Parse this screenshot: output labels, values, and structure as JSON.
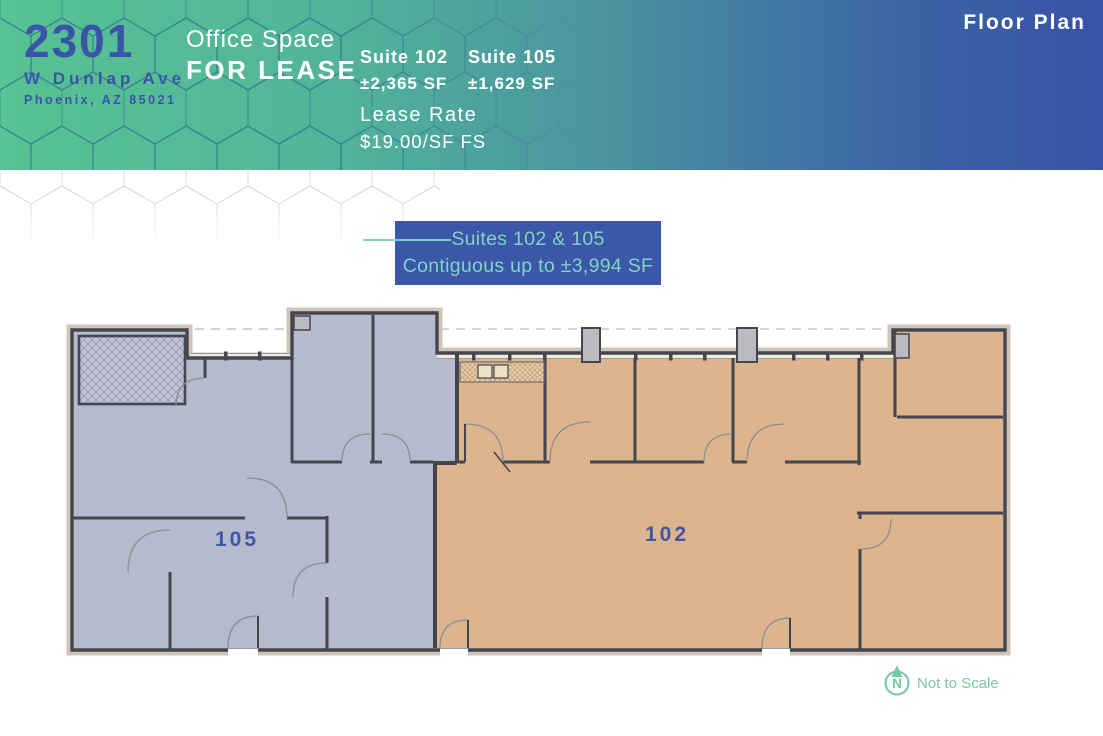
{
  "header": {
    "address_number": "2301",
    "address_street": "W Dunlap Ave",
    "address_city": "Phoenix, AZ 85021",
    "offer_line1": "Office Space",
    "offer_line2": "FOR LEASE",
    "page_label": "Floor Plan",
    "suites": [
      {
        "name": "Suite 102",
        "area": "±2,365 SF"
      },
      {
        "name": "Suite 105",
        "area": "±1,629 SF"
      }
    ],
    "lease_rate_label": "Lease Rate",
    "lease_rate_value": "$19.00/SF FS"
  },
  "callout": {
    "line1": "Suites 102 & 105",
    "line2": "Contiguous up to ±3,994 SF"
  },
  "floor_plan": {
    "suite_105_label": "105",
    "suite_102_label": "102",
    "compass_letter": "N",
    "not_to_scale_label": "Not to Scale"
  },
  "colors": {
    "gradient_start": "#57c294",
    "gradient_mid": "#4a93a0",
    "gradient_end": "#3853a6",
    "brand_blue": "#3b55a6",
    "callout_bg": "#3c57a8",
    "callout_text": "#80d4c4",
    "suite_105_fill": "#b6bacd",
    "suite_102_fill": "#dcb48e",
    "wall": "#45454d",
    "compass_green": "#74c8a3"
  }
}
